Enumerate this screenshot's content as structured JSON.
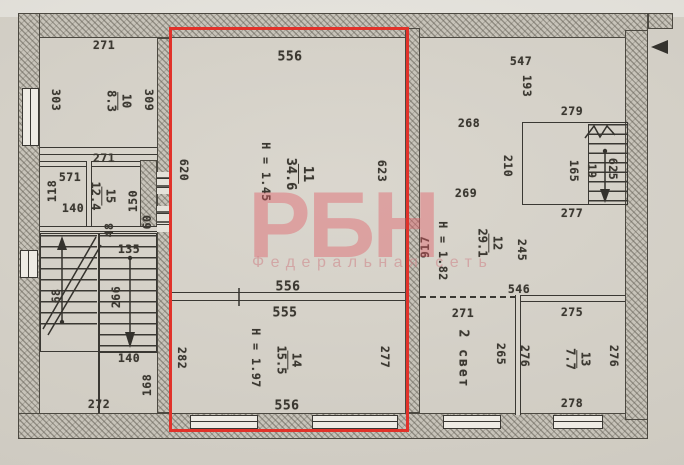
{
  "document": {
    "type": "scanned BTI floor plan (technical passport drawing)",
    "highlight_note": "red rectangle outlining rooms 11 and 14"
  },
  "watermark": {
    "logo": "РБН",
    "tagline": "Федеральная сеть"
  },
  "colors": {
    "paper": "#d8d4cb",
    "ink": "#3b3831",
    "highlight_red": "#e1322a",
    "watermark_pink": "#e05a64"
  },
  "rooms": {
    "r10": {
      "number": "10",
      "area": "8.3"
    },
    "r11": {
      "number": "11",
      "area": "34.6",
      "height": "H = 1.45"
    },
    "r12": {
      "number": "12",
      "area": "29.1",
      "height": "H = 1.82"
    },
    "r13": {
      "number": "13",
      "area": "7.7"
    },
    "r14": {
      "number": "14",
      "area": "15.5",
      "height": "H = 1.97"
    },
    "r15": {
      "number": "15",
      "area": "12.4"
    },
    "svet": {
      "label": "2 свет"
    }
  },
  "dims": {
    "top_271": "271",
    "r11_top_556": "556",
    "r12_top_547": "547",
    "stair2_279": "279",
    "r12_268": "268",
    "r12_269": "269",
    "stair2_277": "277",
    "mid_271": "271",
    "closet_571": "571",
    "closet_140": "140",
    "stair_135": "135",
    "stair_140": "140",
    "hall_272": "272",
    "wall_556_top": "556",
    "wall_555": "555",
    "r14_556": "556",
    "r12_546": "546",
    "svet_271": "271",
    "r13_275": "275",
    "r13_278": "278",
    "left_303": "303",
    "r10_309": "309",
    "r11_620": "620",
    "r11_623": "623",
    "r12_193": "193",
    "stair2_210": "210",
    "stair2_165": "165",
    "stair2_19": "19",
    "stair2_625": "625",
    "r12_245": "245",
    "total_917": "917",
    "svet_265": "265",
    "r13_276_left": "276",
    "r13_276_right": "276",
    "r14_282": "282",
    "r14_277": "277",
    "r15_150": "150",
    "closet_118": "118",
    "pass_48": "48",
    "pass_60": "60",
    "stair_266": "266",
    "stair_68": "68",
    "land_168": "168"
  }
}
